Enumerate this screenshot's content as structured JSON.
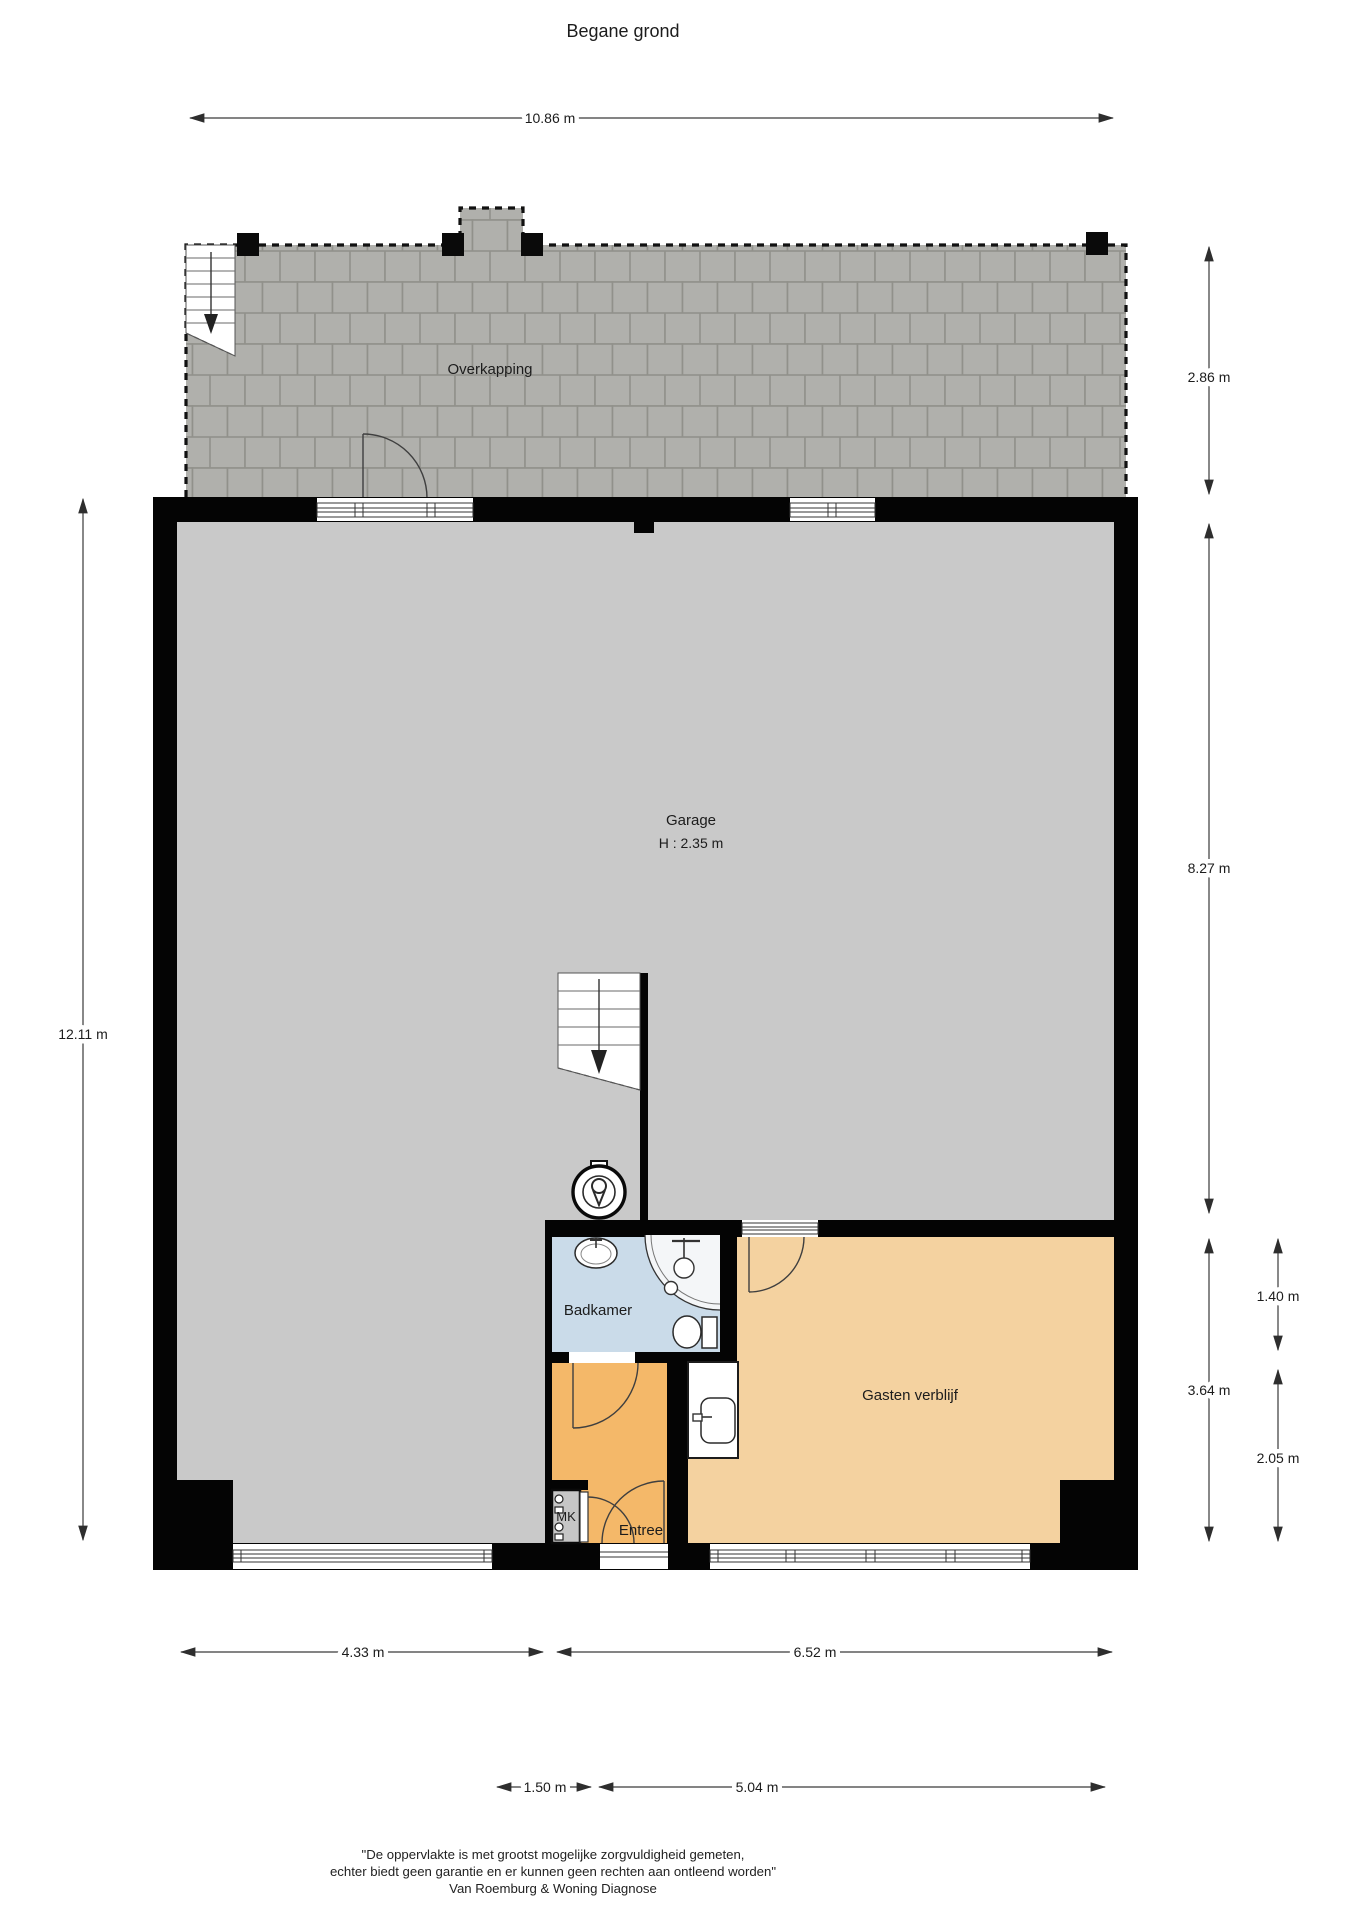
{
  "title": "Begane grond",
  "rooms": {
    "overkapping": {
      "label": "Overkapping"
    },
    "garage": {
      "label": "Garage",
      "height": "H : 2.35 m"
    },
    "badkamer": {
      "label": "Badkamer"
    },
    "gasten_verblijf": {
      "label": "Gasten verblijf"
    },
    "entree": {
      "label": "Entree"
    },
    "meterkast": {
      "label": "MK"
    }
  },
  "dimensions": {
    "top_width": "10.86 m",
    "left_height": "12.11 m",
    "overkapping_depth": "2.86 m",
    "garage_depth": "8.27 m",
    "south_block_depth": "3.64 m",
    "badkamer_zone_depth": "1.40 m",
    "entree_zone_depth": "2.05 m",
    "garage_width": "4.33 m",
    "south_block_width": "6.52 m",
    "entree_width": "1.50 m",
    "gasten_width": "5.04 m"
  },
  "footer": {
    "line1": "\"De oppervlakte is met grootst mogelijke zorgvuldigheid gemeten,",
    "line2": "echter biedt geen garantie en er kunnen geen rechten aan ontleend worden\"",
    "line3": "Van Roemburg & Woning Diagnose"
  },
  "colors": {
    "wall": "#000000",
    "garage_floor": "#c9c9c9",
    "badkamer": "#cadbe9",
    "entree": "#f4b869",
    "gasten_verblijf": "#f4d2a0",
    "tile_face": "#b2b2ae",
    "tile_joint": "#91918b",
    "meterkast_fill": "#c6c6c6"
  },
  "icons": {
    "boiler": "boiler-icon",
    "stairs_down": "stairs-down-arrow-icon",
    "shower": "shower-icon",
    "sink": "sink-icon",
    "toilet": "toilet-icon"
  }
}
